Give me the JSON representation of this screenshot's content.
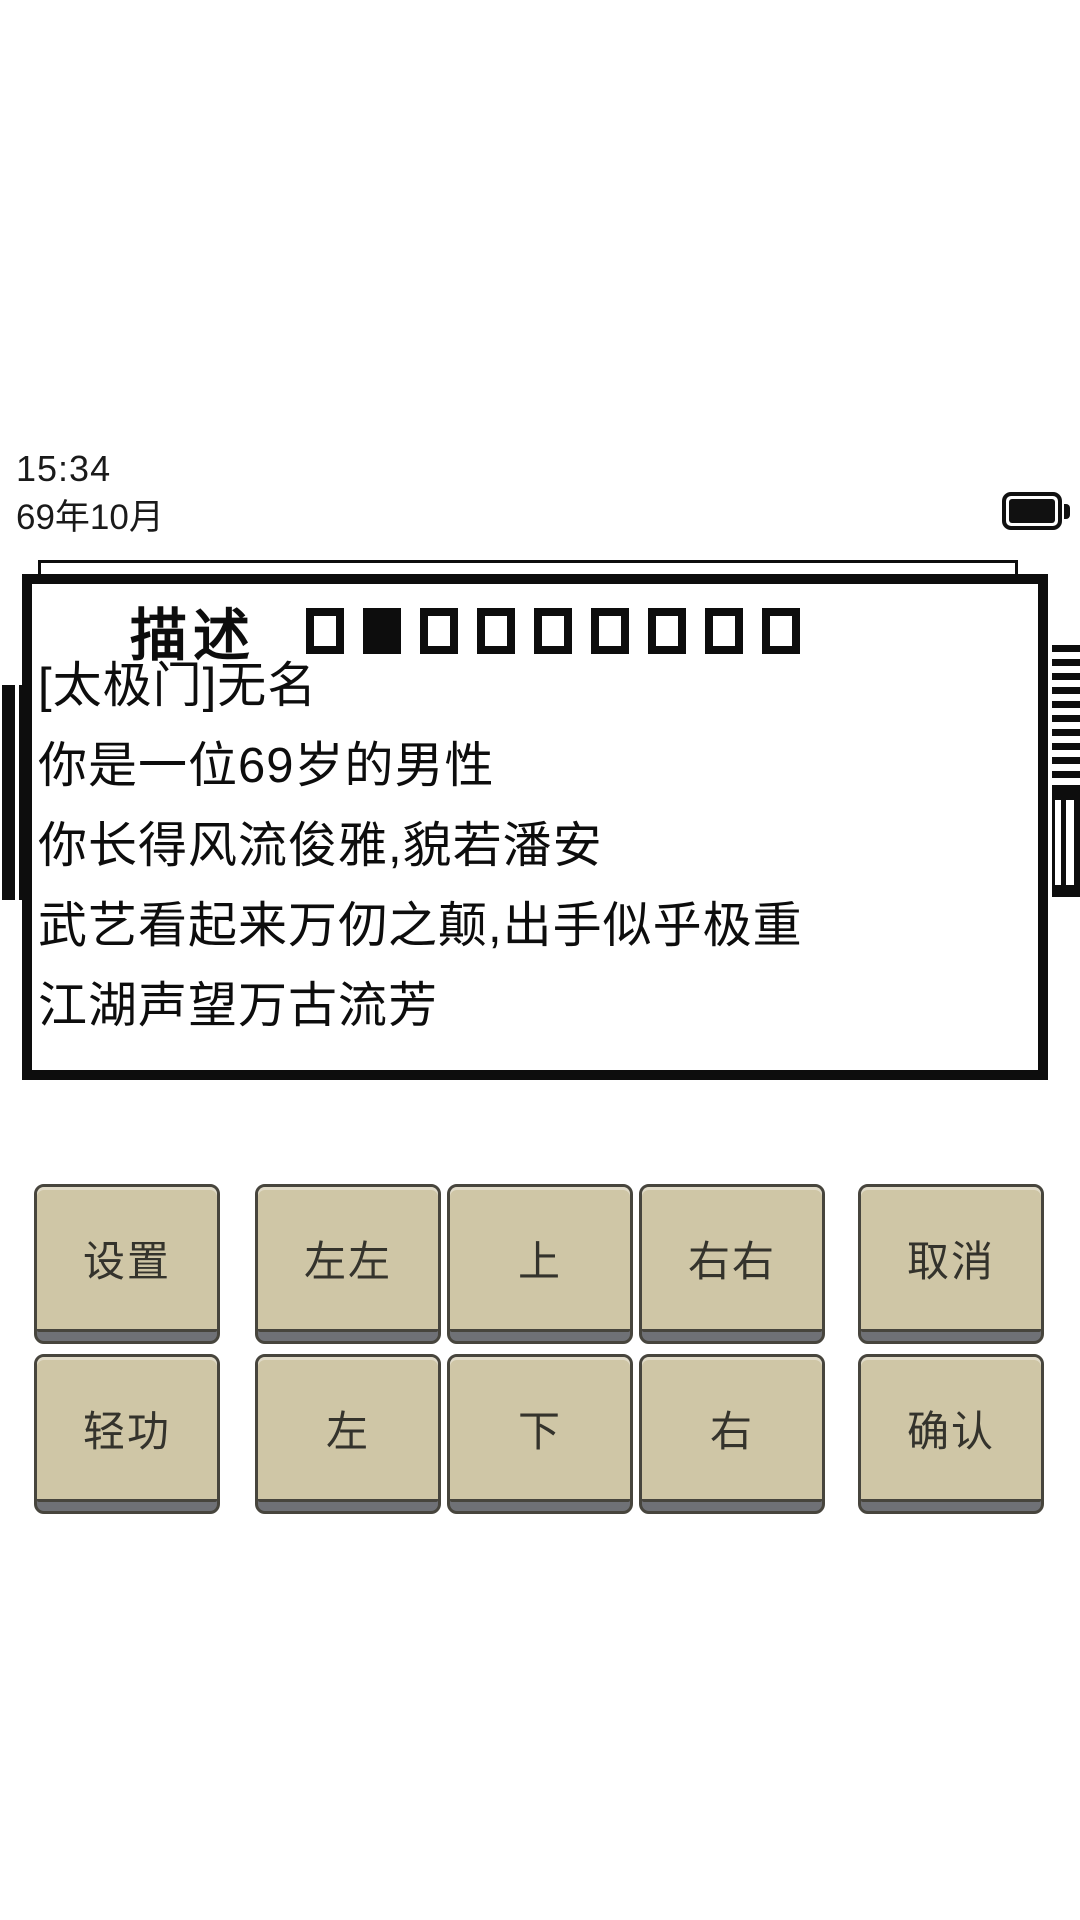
{
  "status": {
    "time": "15:34",
    "game_date": "69年10月",
    "battery": "full"
  },
  "panel": {
    "title": "描述",
    "page_indicator": {
      "total": 9,
      "active_index": 1
    },
    "lines": [
      "[太极门]无名",
      "你是一位69岁的男性",
      "你长得风流俊雅,貌若潘安",
      "武艺看起来万仞之颠,出手似乎极重",
      "江湖声望万古流芳"
    ]
  },
  "controls": {
    "rows": [
      {
        "buttons": [
          {
            "label": "设置",
            "name": "settings-button"
          },
          {
            "label": "左左",
            "name": "move-left-fast-button"
          },
          {
            "label": "上",
            "name": "move-up-button"
          },
          {
            "label": "右右",
            "name": "move-right-fast-button"
          },
          {
            "label": "取消",
            "name": "cancel-button"
          }
        ]
      },
      {
        "buttons": [
          {
            "label": "轻功",
            "name": "lightness-skill-button"
          },
          {
            "label": "左",
            "name": "move-left-button"
          },
          {
            "label": "下",
            "name": "move-down-button"
          },
          {
            "label": "右",
            "name": "move-right-button"
          },
          {
            "label": "确认",
            "name": "confirm-button"
          }
        ]
      }
    ]
  },
  "colors": {
    "ink": "#0d0d0d",
    "button_bg": "#cfc6a6",
    "button_edge": "#6f7176",
    "button_border": "#47453d",
    "button_text": "#34332c"
  }
}
